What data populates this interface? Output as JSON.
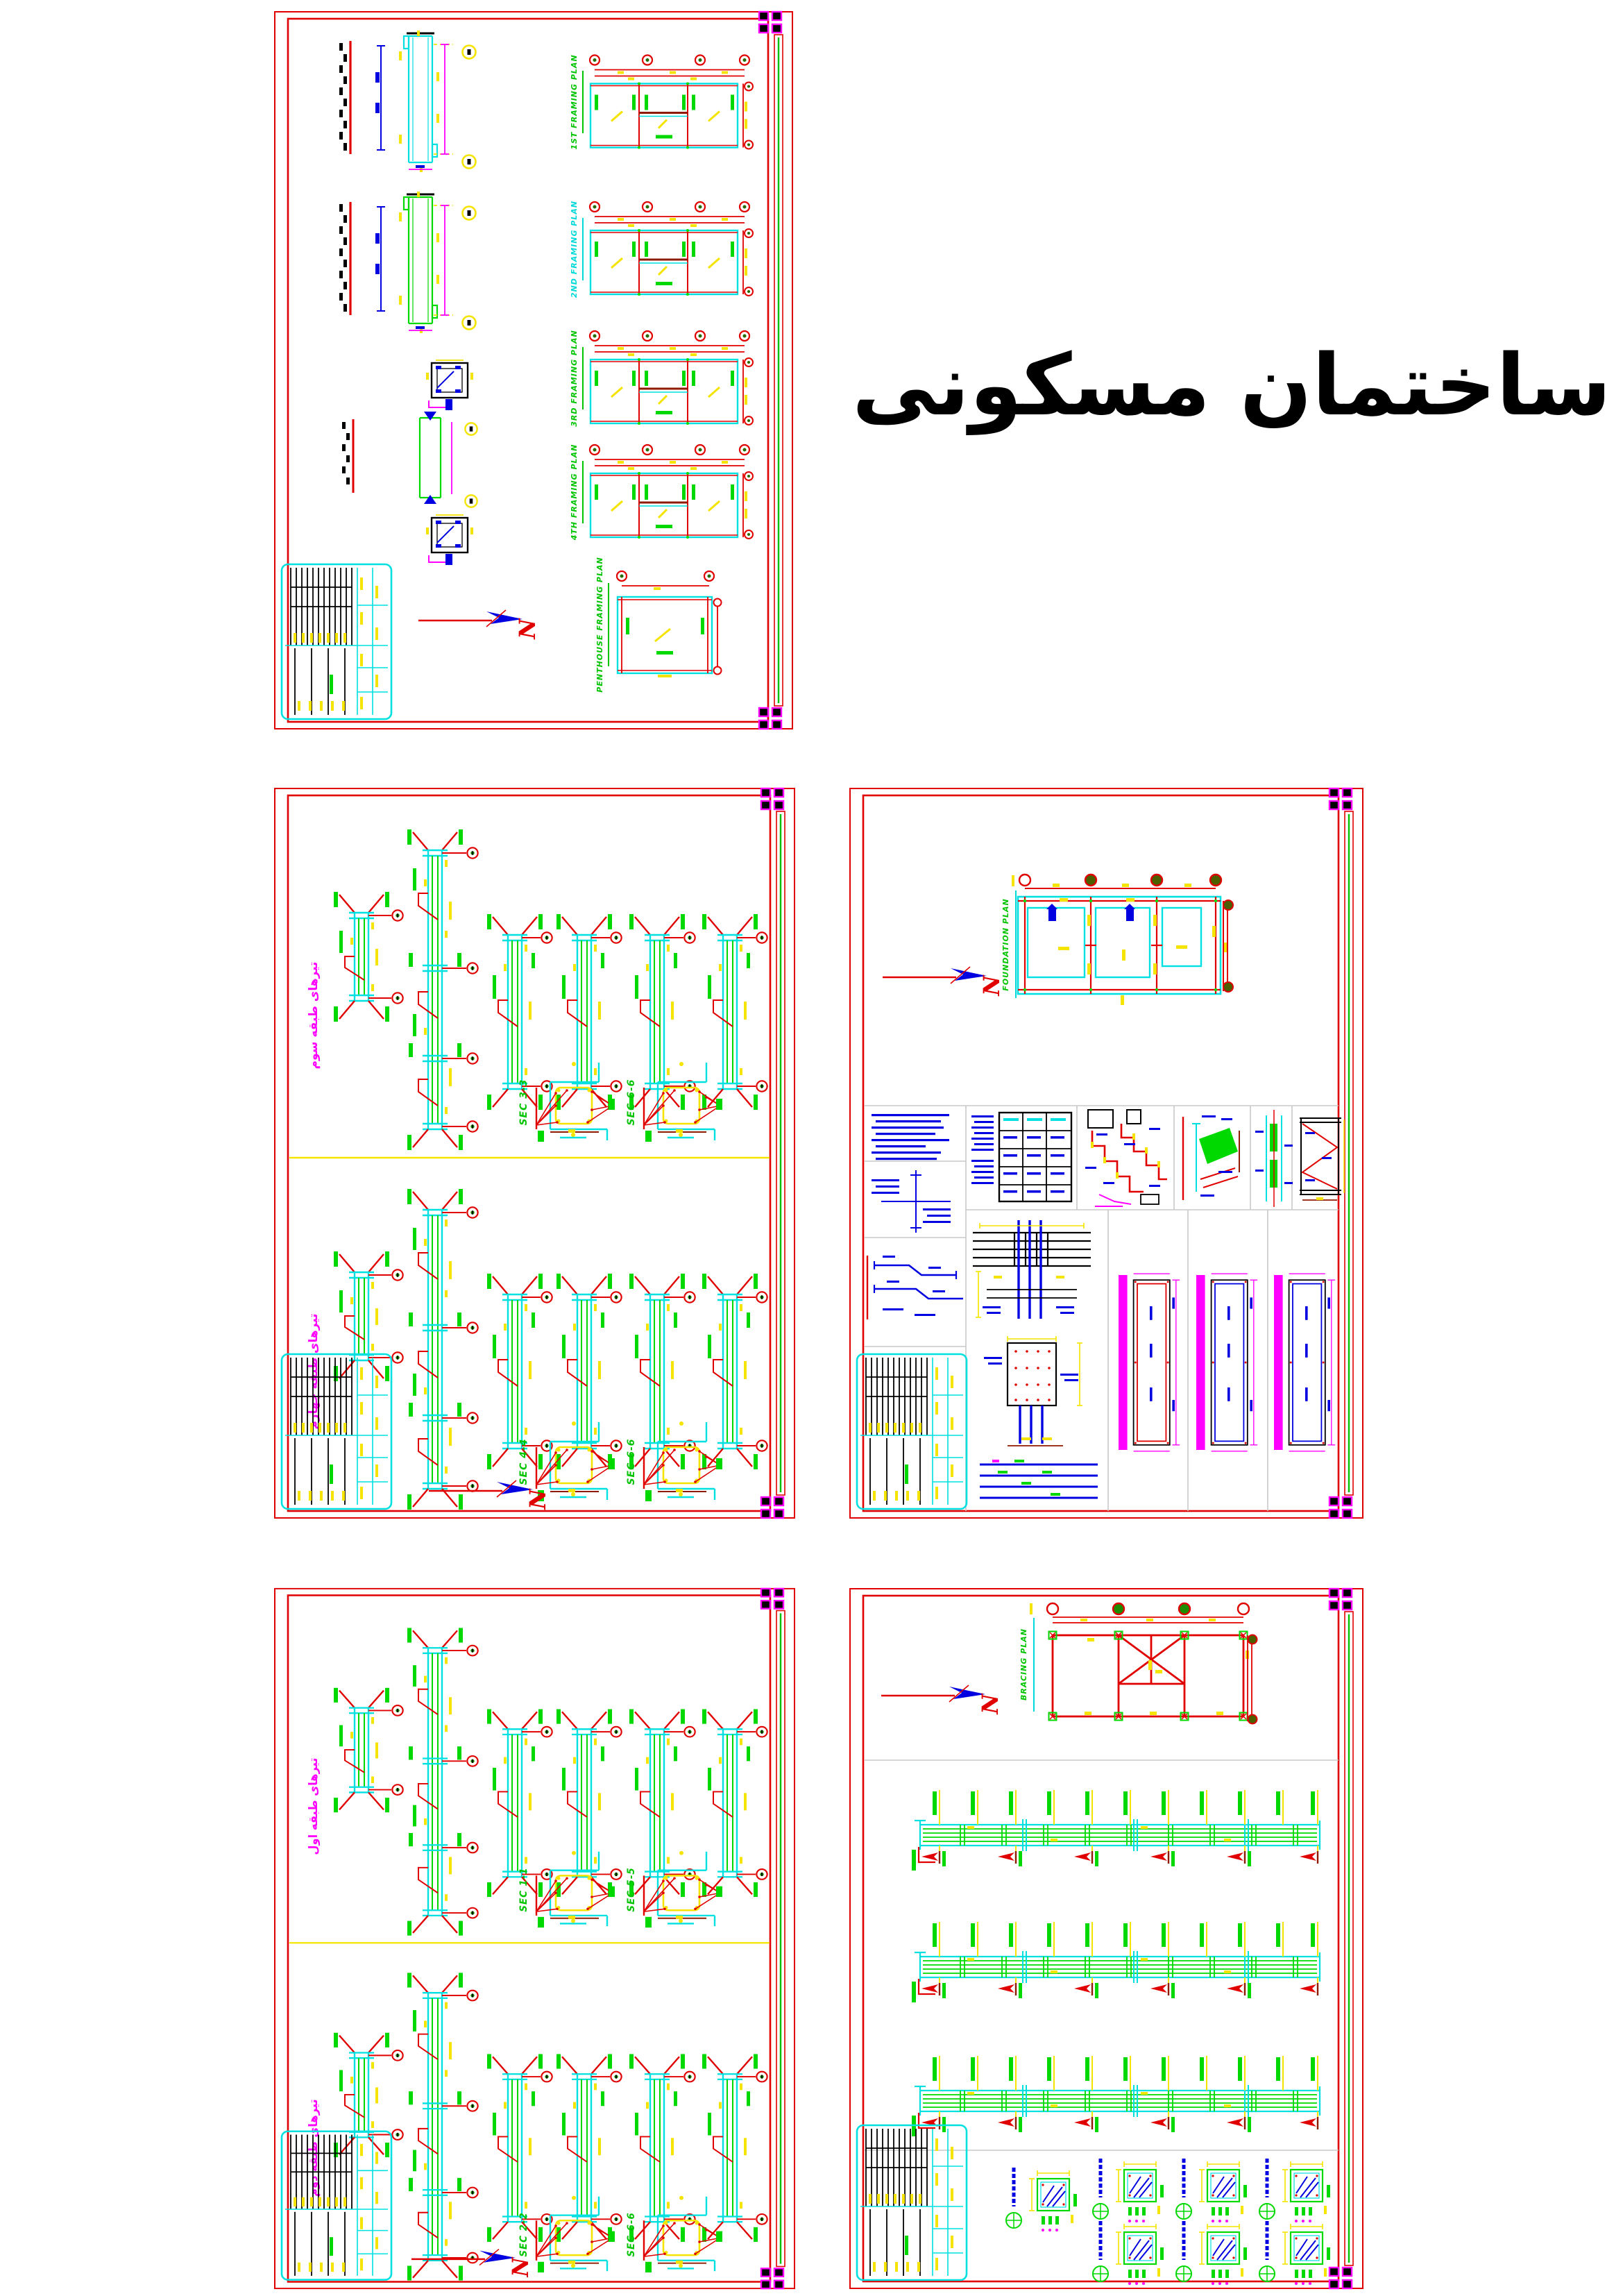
{
  "title": {
    "text": "ساختمان مسکونی"
  },
  "north_letter": "N",
  "colors": {
    "border_red": "#e00000",
    "cad_cyan": "#00e0e0",
    "cad_green": "#00d900",
    "cad_yellow": "#f4e400",
    "cad_blue": "#0000e0",
    "cad_magenta": "#ff00ff",
    "cad_maroon": "#8e1a00",
    "cell_gray": "#c8c8c8"
  },
  "sheet1": {
    "name": "framing plans sheet",
    "plan_labels": [
      "1ST FRAMING PLAN",
      "2ND FRAMING PLAN",
      "3RD FRAMING PLAN",
      "4TH FRAMING PLAN",
      "PENTHOUSE FRAMING PLAN"
    ]
  },
  "sheet2": {
    "top_label": "تیرهای طبقه سوم",
    "bottom_label": "تیرهای طبقه چهارم",
    "sec_top": [
      "SEC 3-3",
      "SEC 6-6"
    ],
    "sec_bottom": [
      "SEC 4-4",
      "SEC 6-6"
    ]
  },
  "sheet3": {
    "plan_label": "FOUNDATION PLAN"
  },
  "sheet4": {
    "top_label": "تیرهای طبقه اول",
    "bottom_label": "تیرهای طبقه دوم",
    "sec_top": [
      "SEC 1-1",
      "SEC 5-5"
    ],
    "sec_bottom": [
      "SEC 2-2",
      "SEC 6-6"
    ]
  },
  "sheet5": {
    "plan_label": "BRACING PLAN"
  }
}
